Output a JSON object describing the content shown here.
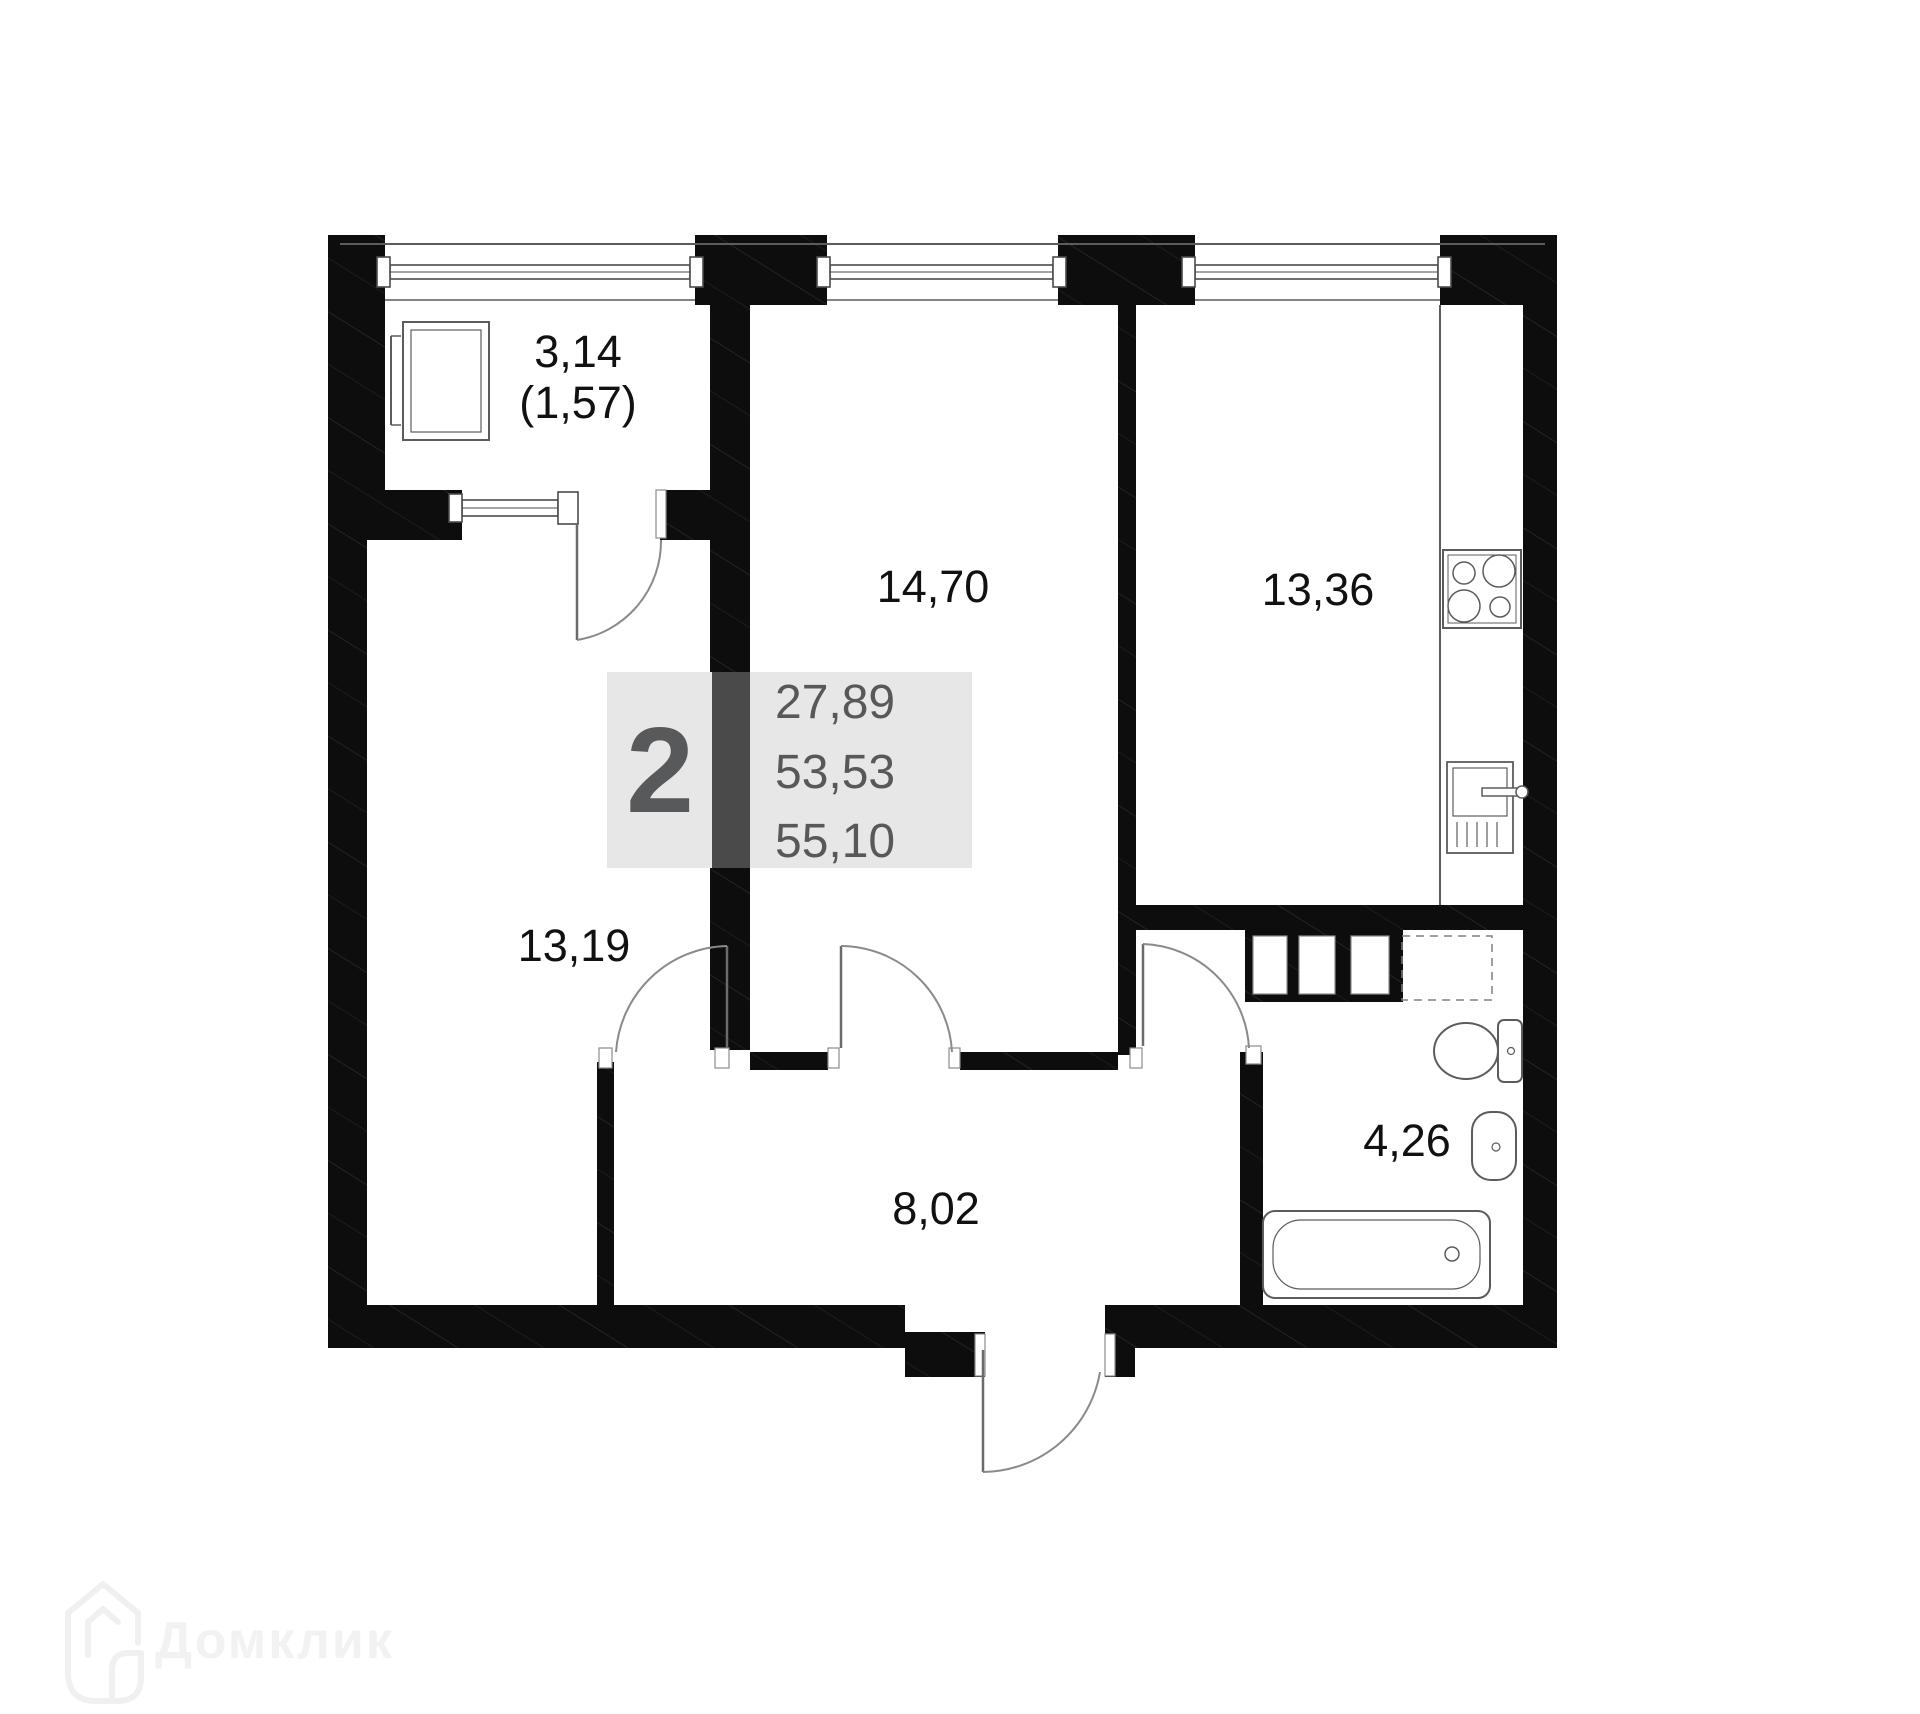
{
  "colors": {
    "wall": "#0d0d0d",
    "fixture_line": "#5c5c5c",
    "label_text": "#111111",
    "info_bg": "#e7e7e7",
    "info_wall_strip": "#4a4a4a",
    "info_text": "#57585a",
    "watermark": "#f2f2f2"
  },
  "info_block": {
    "room_count": "2",
    "living_area": "27,89",
    "area_no_balcony": "53,53",
    "total_area": "55,10"
  },
  "rooms": {
    "balcony": {
      "area": "3,14",
      "area_reduced": "(1,57)"
    },
    "bedroom": {
      "area": "14,70"
    },
    "kitchen": {
      "area": "13,36"
    },
    "living_room": {
      "area": "13,19"
    },
    "hallway": {
      "area": "8,02"
    },
    "bathroom": {
      "area": "4,26"
    }
  },
  "watermark": {
    "brand": "Домклик"
  }
}
